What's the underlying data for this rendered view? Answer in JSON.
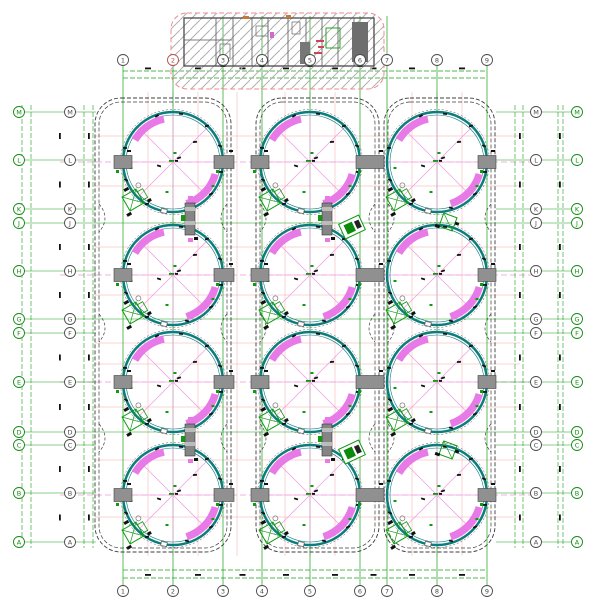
{
  "drawing": {
    "title": "tank-farm-site-plan",
    "canvas": {
      "width": 600,
      "height": 600,
      "background": "#ffffff"
    },
    "colors": {
      "tank_rim": "#0c7d7d",
      "tank_rim_outline": "#555555",
      "stair_magenta": "#e87ae8",
      "grid_green": "#18a018",
      "grid_pink": "#f2aaaa",
      "centerline_pink": "#ee9ad9",
      "containment_outline": "#3c3c3c",
      "block_fill": "#909090",
      "block_stroke": "#404040",
      "bubble_green": "#128a12",
      "bubble_dark": "#4a4a4a",
      "bubble_red": "#b05050",
      "hatch_gray": "#b0b0b0",
      "wall_gray": "#4a4a4a",
      "equip_green": "#0f9a0f",
      "accent_red": "#cc4455",
      "accent_orange": "#c87830",
      "mark_black": "#111111"
    },
    "axes": {
      "vertical": {
        "labels": [
          "1",
          "2",
          "3",
          "4",
          "5",
          "6",
          "7",
          "8",
          "9"
        ],
        "x": [
          123,
          173,
          223,
          262,
          310,
          360,
          387,
          437,
          487
        ],
        "top_bubble_y": 60,
        "bottom_bubble_y": 591,
        "top_red_label_index": 1
      },
      "horizontal": {
        "labels": [
          "M",
          "L",
          "K",
          "J",
          "H",
          "G",
          "F",
          "E",
          "D",
          "C",
          "B",
          "A"
        ],
        "y": [
          112,
          160,
          209,
          223,
          271,
          319,
          333,
          382,
          432,
          445,
          493,
          542
        ],
        "left_outer_x": 13,
        "left_inner_x": 70,
        "right_inner_x": 536,
        "right_outer_x": 577,
        "full_span_labels": [
          "J",
          "G",
          "D"
        ]
      }
    },
    "tanks": {
      "count": 12,
      "rows": 4,
      "cols": 3,
      "cx": [
        173,
        310,
        437
      ],
      "cy": [
        162,
        275,
        382,
        495
      ],
      "radius": 50,
      "stair_arcs_deg": [
        [
          102,
          150
        ],
        [
          -16,
          -72
        ]
      ]
    },
    "containment_columns": [
      {
        "x": 95,
        "width": 136
      },
      {
        "x": 256,
        "width": 123
      },
      {
        "x": 384,
        "width": 111
      }
    ],
    "containment": {
      "top": 98,
      "height": 454,
      "corner_radius": 26,
      "neck_y": [
        218,
        328,
        438
      ]
    },
    "building": {
      "border": {
        "x": 171,
        "y": 13,
        "width": 213,
        "height": 76,
        "corner_radius": 16
      },
      "walls": {
        "x": 184,
        "y": 18,
        "width": 190,
        "height": 48
      },
      "partition_x": [
        216,
        233,
        252,
        268,
        288,
        306,
        322,
        338,
        354
      ]
    },
    "rim_blocks_x": [
      {
        "cx": 123,
        "w": 18
      },
      {
        "cx": 224,
        "w": 20
      },
      {
        "cx": 260,
        "w": 18
      },
      {
        "cx": 370,
        "w": 28
      },
      {
        "cx": 487,
        "w": 18
      }
    ],
    "ladders_xy": [
      [
        190,
        219
      ],
      [
        327,
        219
      ],
      [
        190,
        440
      ],
      [
        327,
        440
      ]
    ],
    "machines_xy": [
      [
        352,
        227
      ],
      [
        352,
        452
      ]
    ],
    "side_clusters_xy": [
      [
        448,
        222
      ],
      [
        448,
        450
      ]
    ],
    "margin_lines": {
      "left_x": [
        22,
        31,
        84,
        93
      ],
      "right_x": [
        515,
        523,
        558,
        563
      ],
      "top_dim_y": [
        71,
        78
      ],
      "bottom_dim_y": [
        570,
        578
      ]
    }
  }
}
